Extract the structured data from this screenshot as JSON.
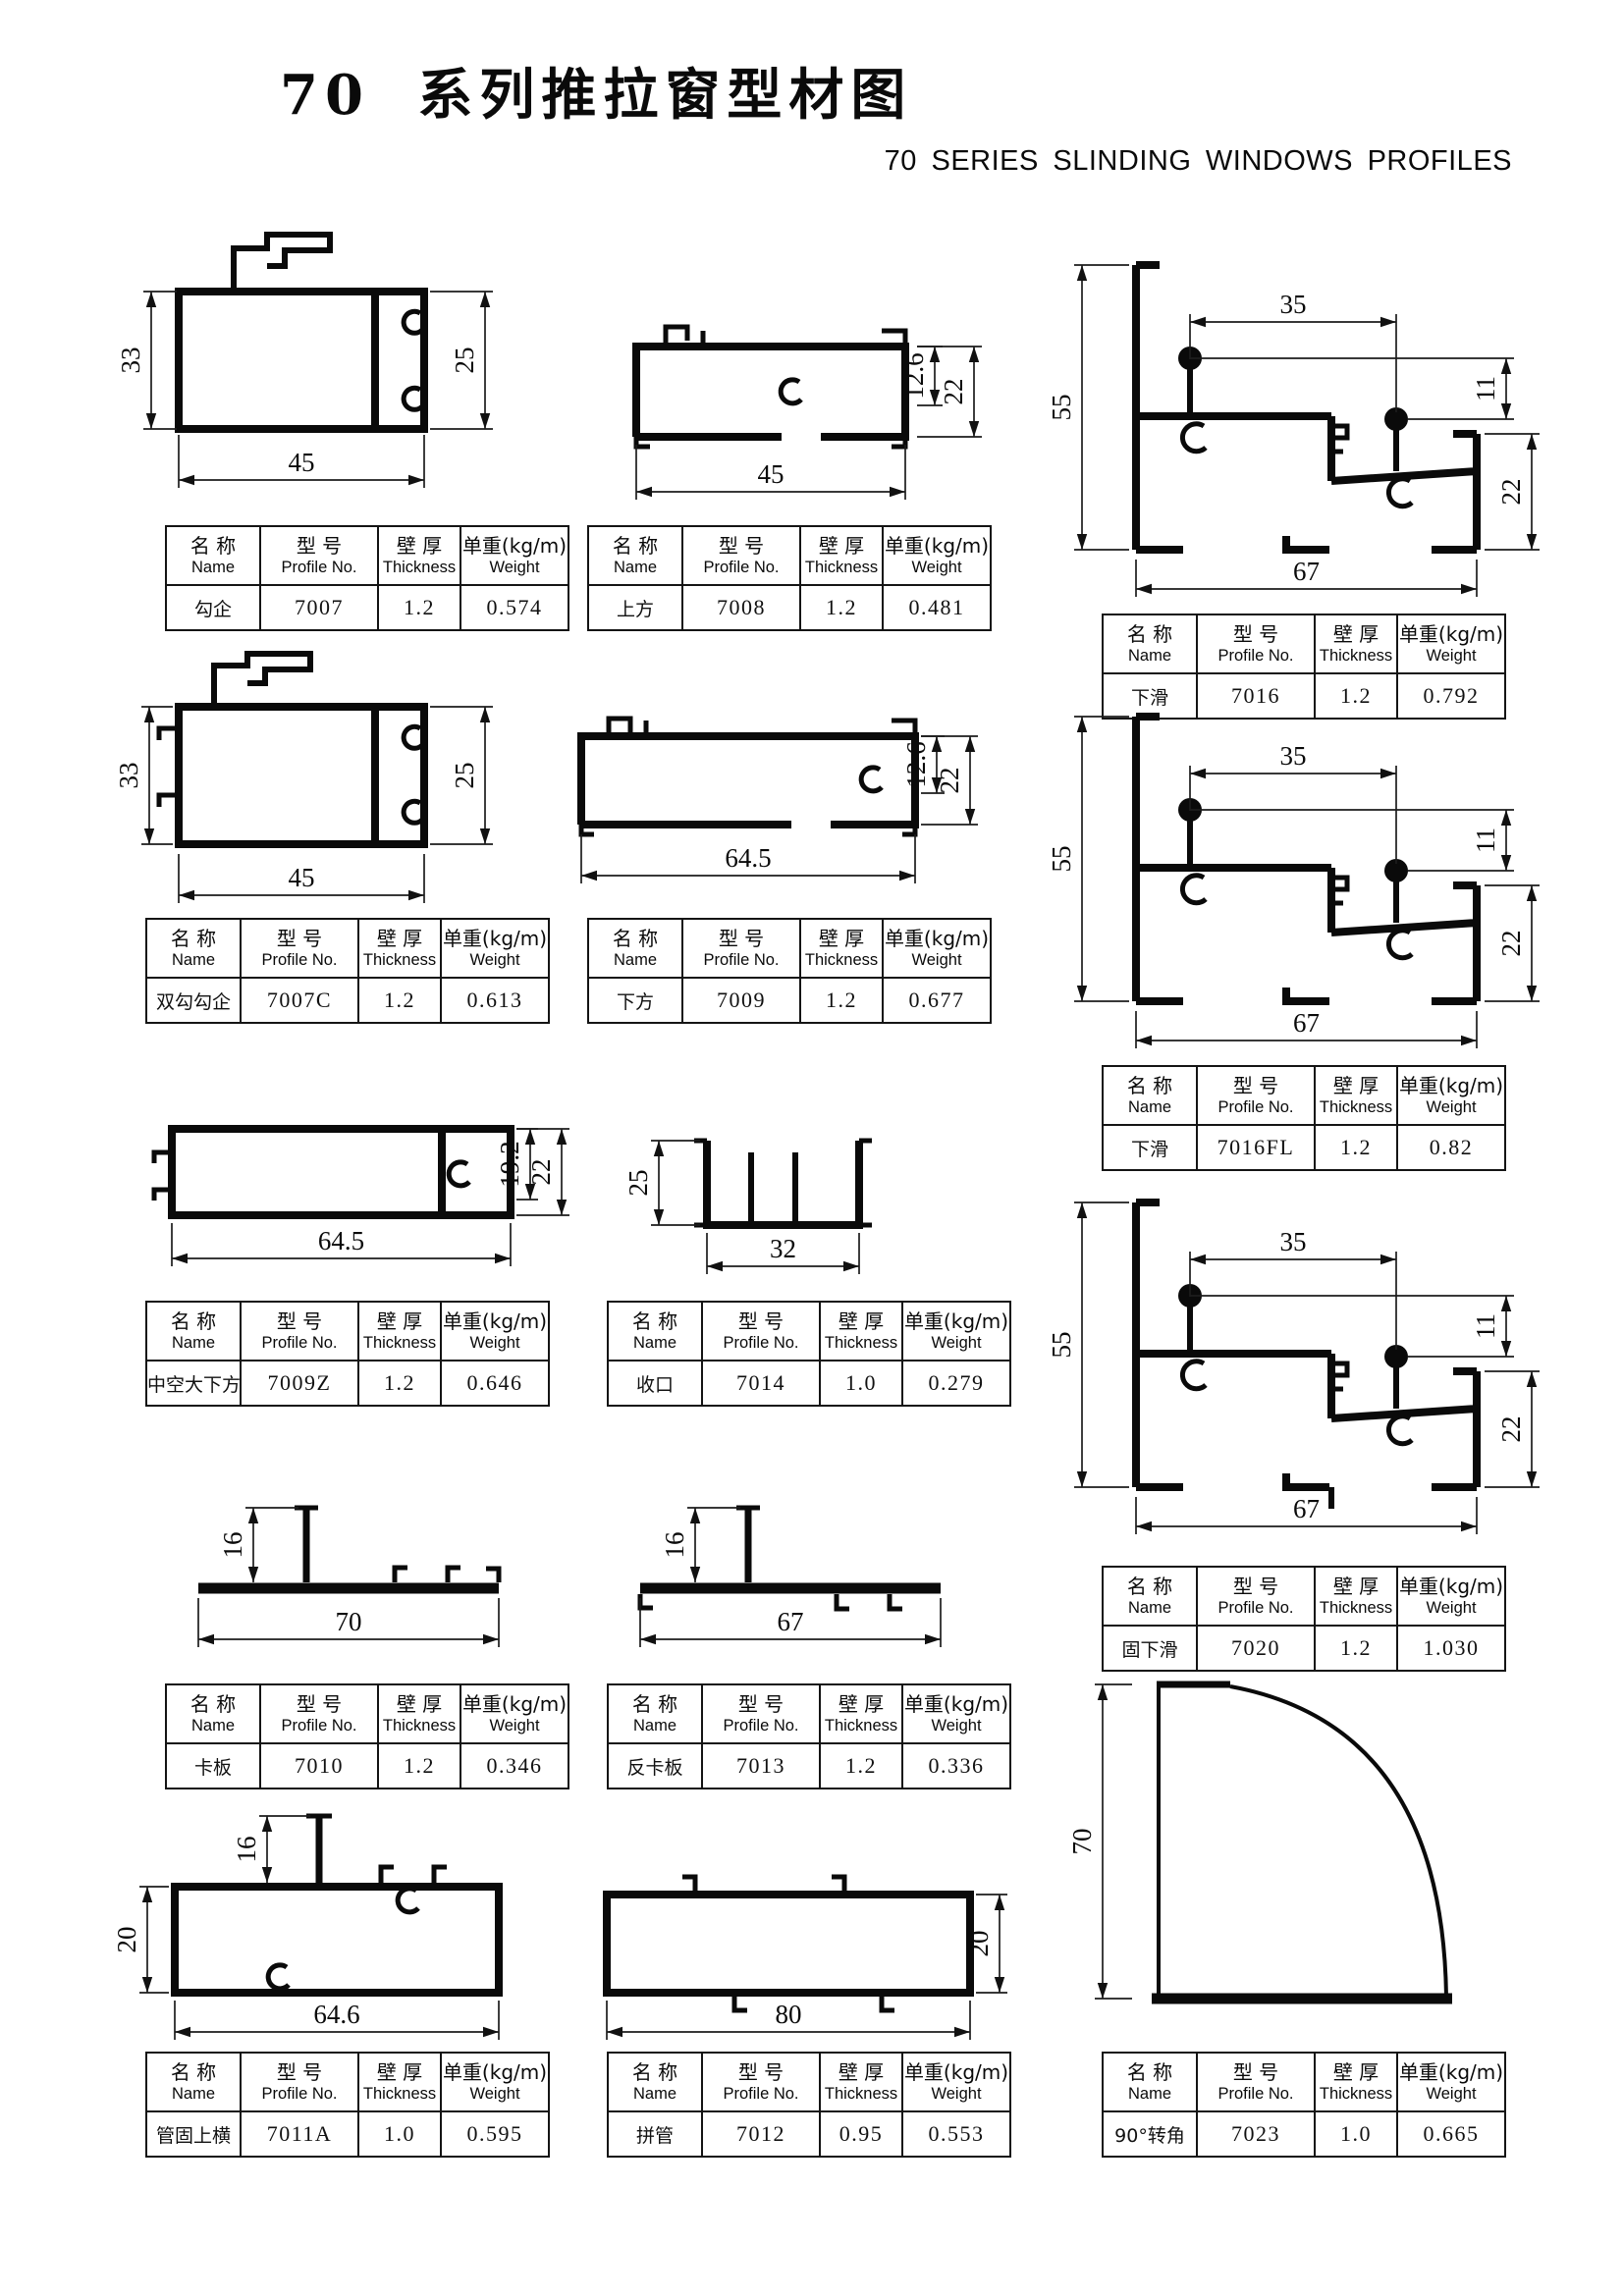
{
  "page": {
    "title": "70 系列推拉窗型材图",
    "subtitle": "70 SERIES  SLINDING WINDOWS PROFILES"
  },
  "colors": {
    "ink": "#0a0a0a",
    "paper": "#ffffff"
  },
  "table_header": {
    "name_cn": "名 称",
    "name_en": "Name",
    "model_cn": "型 号",
    "model_en": "Profile No.",
    "thickness_cn": "壁 厚",
    "thickness_en": "Thickness",
    "weight_cn": "单重(kg/m)",
    "weight_en": "Weight"
  },
  "profiles": [
    {
      "name": "勾企",
      "profile_no": "7007",
      "thickness": "1.2",
      "weight": "0.574",
      "dims": [
        "33",
        "25",
        "45"
      ]
    },
    {
      "name": "上方",
      "profile_no": "7008",
      "thickness": "1.2",
      "weight": "0.481",
      "dims": [
        "12.6",
        "22",
        "45"
      ]
    },
    {
      "name": "下滑",
      "profile_no": "7016",
      "thickness": "1.2",
      "weight": "0.792",
      "dims": [
        "35",
        "11",
        "55",
        "22",
        "67"
      ]
    },
    {
      "name": "双勾勾企",
      "profile_no": "7007C",
      "thickness": "1.2",
      "weight": "0.613",
      "dims": [
        "33",
        "25",
        "45"
      ]
    },
    {
      "name": "下方",
      "profile_no": "7009",
      "thickness": "1.2",
      "weight": "0.677",
      "dims": [
        "12.6",
        "22",
        "64.5"
      ]
    },
    {
      "name": "下滑",
      "profile_no": "7016FL",
      "thickness": "1.2",
      "weight": "0.82",
      "dims": [
        "35",
        "11",
        "55",
        "22",
        "67"
      ]
    },
    {
      "name": "中空大下方",
      "profile_no": "7009Z",
      "thickness": "1.2",
      "weight": "0.646",
      "dims": [
        "19.2",
        "22",
        "64.5"
      ]
    },
    {
      "name": "收口",
      "profile_no": "7014",
      "thickness": "1.0",
      "weight": "0.279",
      "dims": [
        "25",
        "32"
      ]
    },
    {
      "name": "固下滑",
      "profile_no": "7020",
      "thickness": "1.2",
      "weight": "1.030",
      "dims": [
        "35",
        "11",
        "55",
        "22",
        "67"
      ]
    },
    {
      "name": "卡板",
      "profile_no": "7010",
      "thickness": "1.2",
      "weight": "0.346",
      "dims": [
        "16",
        "70"
      ]
    },
    {
      "name": "反卡板",
      "profile_no": "7013",
      "thickness": "1.2",
      "weight": "0.336",
      "dims": [
        "16",
        "67"
      ]
    },
    {
      "name": "管固上横",
      "profile_no": "7011A",
      "thickness": "1.0",
      "weight": "0.595",
      "dims": [
        "16",
        "20",
        "64.6"
      ]
    },
    {
      "name": "拼管",
      "profile_no": "7012",
      "thickness": "0.95",
      "weight": "0.553",
      "dims": [
        "20",
        "80"
      ]
    },
    {
      "name": "90°转角",
      "profile_no": "7023",
      "thickness": "1.0",
      "weight": "0.665",
      "dims": [
        "70"
      ]
    }
  ]
}
